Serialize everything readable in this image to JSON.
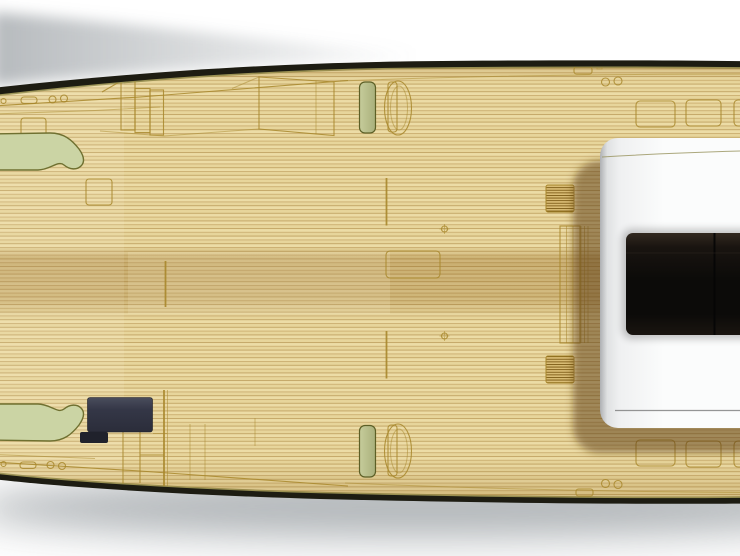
{
  "scene": {
    "type": "yacht-deck-top-view-render",
    "description": "Top-down 3D rendering of a motor yacht deck: teak planking, port and starboard curved bench seats at the bow, deck hatches, vents, fairleads, a dark deck locker box and a white coachroof with dark windscreen on the right, over a white background with soft drop shadow."
  },
  "components": {
    "hull": "dark hull rim",
    "teak_deck": "teak plank deck surface",
    "bench_seat_port": "green curved bench seat (top left)",
    "bench_seat_starboard": "green curved bench seat (bottom left)",
    "bollard_vent_port": "green deck vent (top middle)",
    "bollard_vent_starboard": "green deck vent (bottom middle)",
    "fairlead_port": "fairlead / cleat outline (top middle)",
    "fairlead_starboard": "fairlead / cleat outline (bottom middle)",
    "deck_locker_box": "dark navy deck locker (bottom left)",
    "deck_vent_grill_port": "striped vent grill (upper right of deck)",
    "deck_vent_grill_starboard": "striped vent grill (lower right of deck)",
    "coachroof": "white cabin roof (right)",
    "windscreen": "dark windscreen glass in coachroof",
    "deck_hatches": "gold outlined flush deck hatches",
    "side_deck_steps": "step / ladder outlines beside coachroof"
  },
  "colors": {
    "background": "#ffffff",
    "hull_dark": "#1d1c12",
    "gunwale_gold": "#9a9254",
    "deck_base": "#ecdca6",
    "deck_base_alt": "#e7d59b",
    "plank_line": "#c4a869",
    "plank_line_alt": "#cdb275",
    "outline_gold": "#a8872c",
    "tone_band": "#8c5f19",
    "bench_green": "#cbd4a4",
    "bench_outline": "#6f7030",
    "vent_green_light": "#c6cc9b",
    "vent_green_dark": "#a9b07b",
    "vent_outline": "#5c5f26",
    "grill_fill": "#d9bc74",
    "grill_line": "#7d5c16",
    "navy_box_top": "#4a4d5c",
    "navy_box": "#343747",
    "navy_box_bottom": "#2b2d3a",
    "navy_tab": "#20222c",
    "cabin_edge": "#aeb0b3",
    "cabin_mid": "#dfe1e2",
    "cabin_light": "#eff0f1",
    "cabin_white": "#fbfcfc",
    "cabin_seam": "#97925d",
    "windshield_top": "#322920",
    "windshield_upper": "#191410",
    "windshield_mid": "#0c0b09",
    "windshield_low": "#1a1510",
    "shadow_brown": "#5a3e16",
    "drop_shadow": "#8f959a"
  }
}
